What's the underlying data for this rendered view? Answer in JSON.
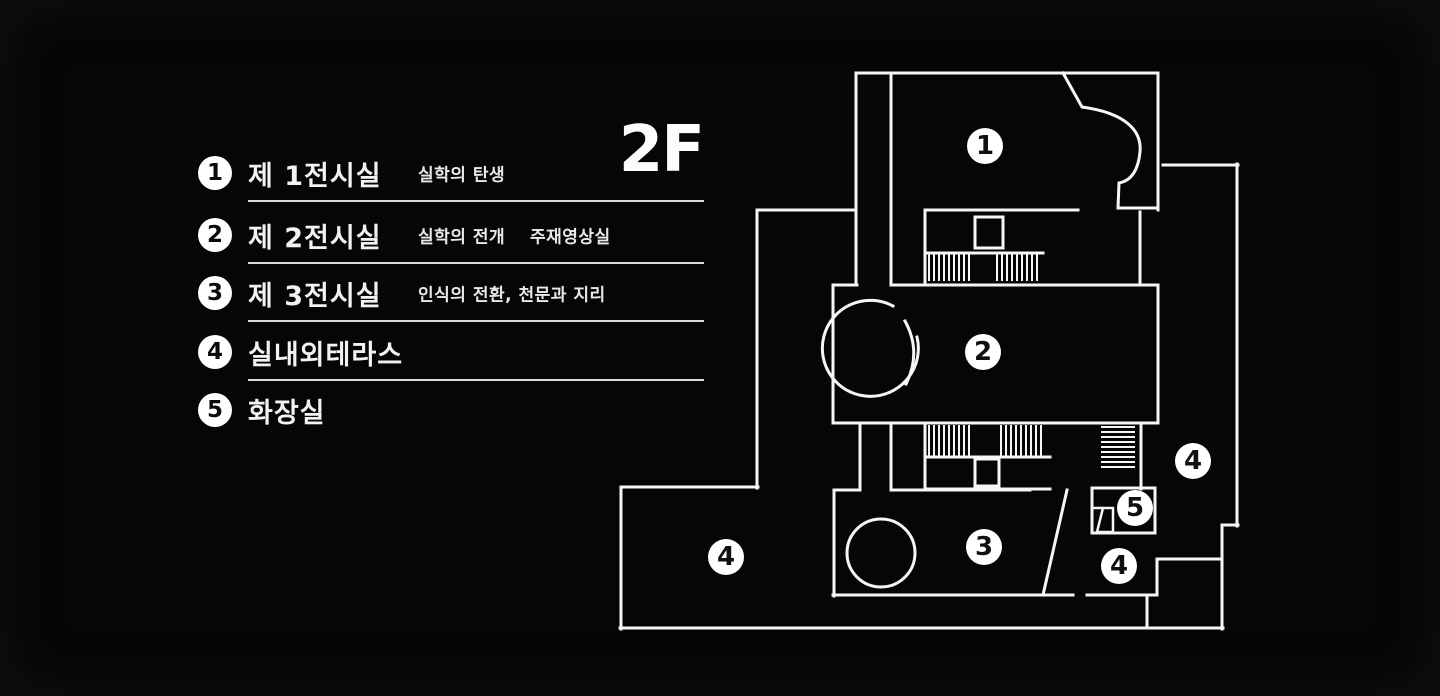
{
  "page": {
    "background": "#060606",
    "line_color": "#f6f6f6",
    "badge_bg": "#ffffff",
    "badge_text": "#101010"
  },
  "floor_label": "2F",
  "legend": {
    "items": [
      {
        "number": "1",
        "label": "제 1전시실",
        "desc": "실학의 탄생",
        "desc2": "",
        "underline": true
      },
      {
        "number": "2",
        "label": "제 2전시실",
        "desc": "실학의 전개",
        "desc2": "주재영상실",
        "underline": true
      },
      {
        "number": "3",
        "label": "제 3전시실",
        "desc": "인식의 전환, 천문과 지리",
        "desc2": "",
        "underline": true
      },
      {
        "number": "4",
        "label": "실내외테라스",
        "desc": "",
        "desc2": "",
        "underline": true
      },
      {
        "number": "5",
        "label": "화장실",
        "desc": "",
        "desc2": "",
        "underline": false
      }
    ]
  },
  "plan": {
    "markers": [
      {
        "number": "1",
        "x": 985,
        "y": 146
      },
      {
        "number": "2",
        "x": 983,
        "y": 352
      },
      {
        "number": "3",
        "x": 984,
        "y": 547
      },
      {
        "number": "4",
        "x": 726,
        "y": 557
      },
      {
        "number": "4",
        "x": 1193,
        "y": 461
      },
      {
        "number": "4",
        "x": 1119,
        "y": 566
      },
      {
        "number": "5",
        "x": 1135,
        "y": 508
      }
    ]
  }
}
